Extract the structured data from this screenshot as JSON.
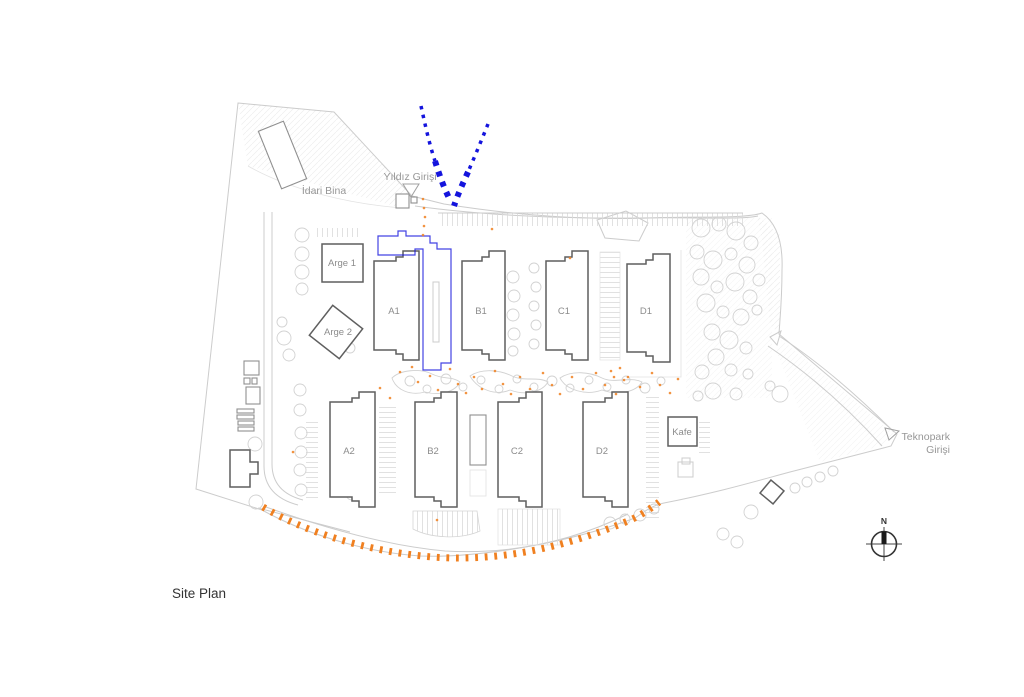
{
  "title": "Site Plan",
  "compass_label": "N",
  "labels": {
    "idari_bina": "İdari Bina",
    "arge1": "Arge 1",
    "arge2": "Arge 2",
    "a1": "A1",
    "b1": "B1",
    "c1": "C1",
    "d1": "D1",
    "a2": "A2",
    "b2": "B2",
    "c2": "C2",
    "d2": "D2",
    "kafe": "Kafe",
    "yildiz_girisi": "Yıldız Girişi",
    "teknopark_line1": "Teknopark",
    "teknopark_line2": "Girişi"
  },
  "colors": {
    "route_blue": "#1414dd",
    "route_orange": "#f08020",
    "building_outline": "#5f5f5f",
    "site_line": "#cccccc",
    "label_gray": "#8c8c8c"
  }
}
